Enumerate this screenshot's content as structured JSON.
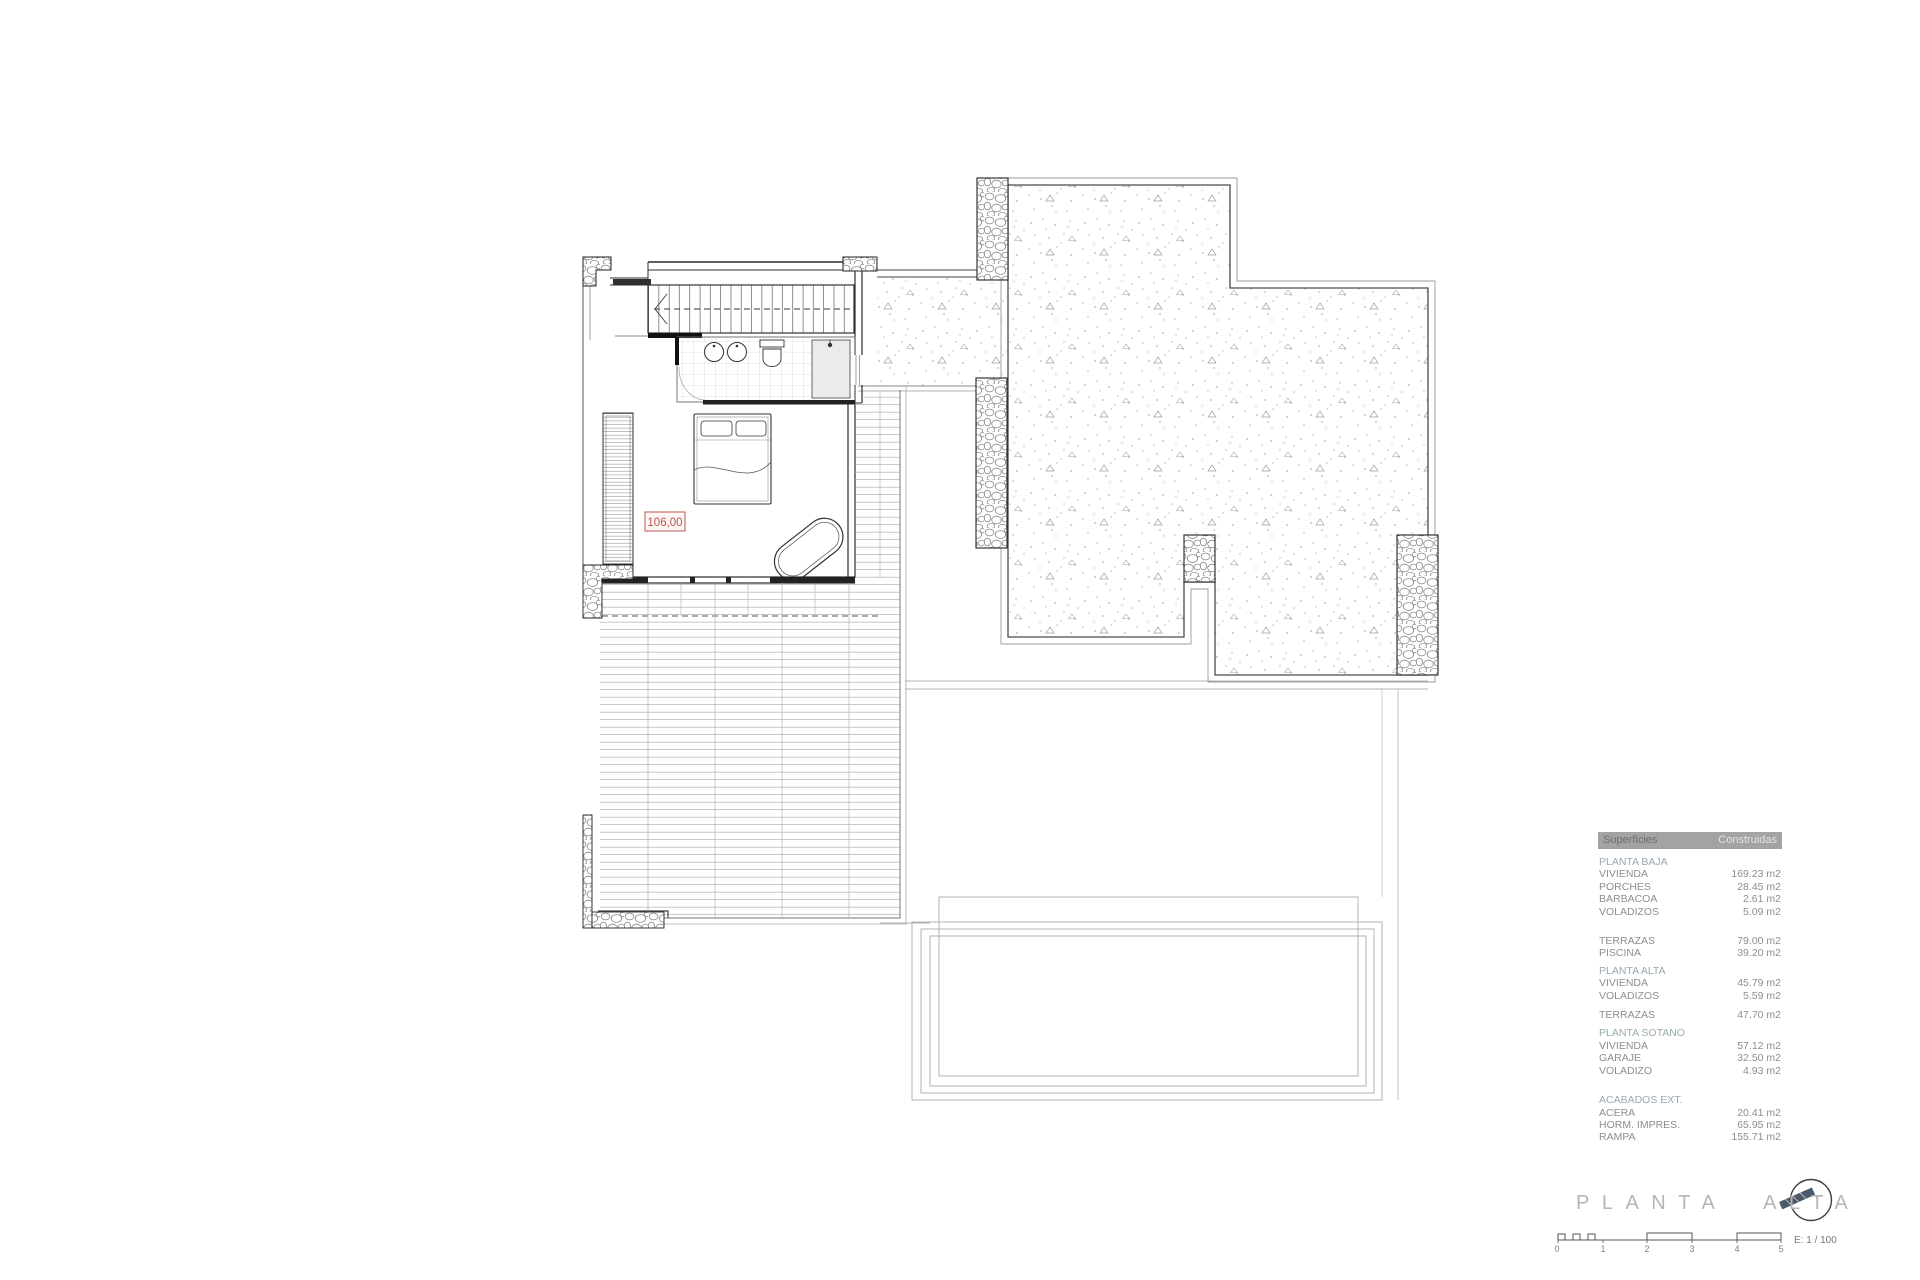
{
  "colors": {
    "accent_red": "#b9574e",
    "section_teal": "#98aab0",
    "table_header_gray": "#a3a3a3",
    "compass_needle_slate": "#4c5a68"
  },
  "plan": {
    "room_area_label": "106,00"
  },
  "area_table": {
    "header": {
      "col1": "Superficies",
      "col2": "Construidas"
    },
    "planta_baja": {
      "title": "PLANTA BAJA",
      "items": [
        {
          "label": "VIVIENDA",
          "value": "169.23 m2"
        },
        {
          "label": "PORCHES",
          "value": "28.45 m2"
        },
        {
          "label": "BARBACOA",
          "value": "2.61 m2"
        },
        {
          "label": "VOLADIZOS",
          "value": "5.09 m2"
        }
      ]
    },
    "terrazas_baja": {
      "items": [
        {
          "label": "TERRAZAS",
          "value": "79.00 m2"
        },
        {
          "label": "PISCINA",
          "value": "39.20 m2"
        }
      ]
    },
    "planta_alta": {
      "title": "PLANTA ALTA",
      "items": [
        {
          "label": "VIVIENDA",
          "value": "45.79 m2"
        },
        {
          "label": "VOLADIZOS",
          "value": "5.59 m2"
        }
      ]
    },
    "terrazas_alta": {
      "items": [
        {
          "label": "TERRAZAS",
          "value": "47.70 m2"
        }
      ]
    },
    "planta_sotano": {
      "title": "PLANTA SOTANO",
      "items": [
        {
          "label": "VIVIENDA",
          "value": "57.12 m2"
        },
        {
          "label": "GARAJE",
          "value": "32.50 m2"
        },
        {
          "label": "VOLADIZO",
          "value": "4.93 m2"
        }
      ]
    },
    "acabados": {
      "title": "ACABADOS EXT.",
      "items": [
        {
          "label": "ACERA",
          "value": "20.41 m2"
        },
        {
          "label": "HORM. IMPRES.",
          "value": "65.95 m2"
        },
        {
          "label": "RAMPA",
          "value": "155.71 m2"
        }
      ]
    }
  },
  "title_block": {
    "title": "PLANTA ALTA",
    "scale_label": "E: 1 / 100",
    "scale_ticks": [
      "0",
      "1",
      "2",
      "3",
      "4",
      "5"
    ]
  }
}
